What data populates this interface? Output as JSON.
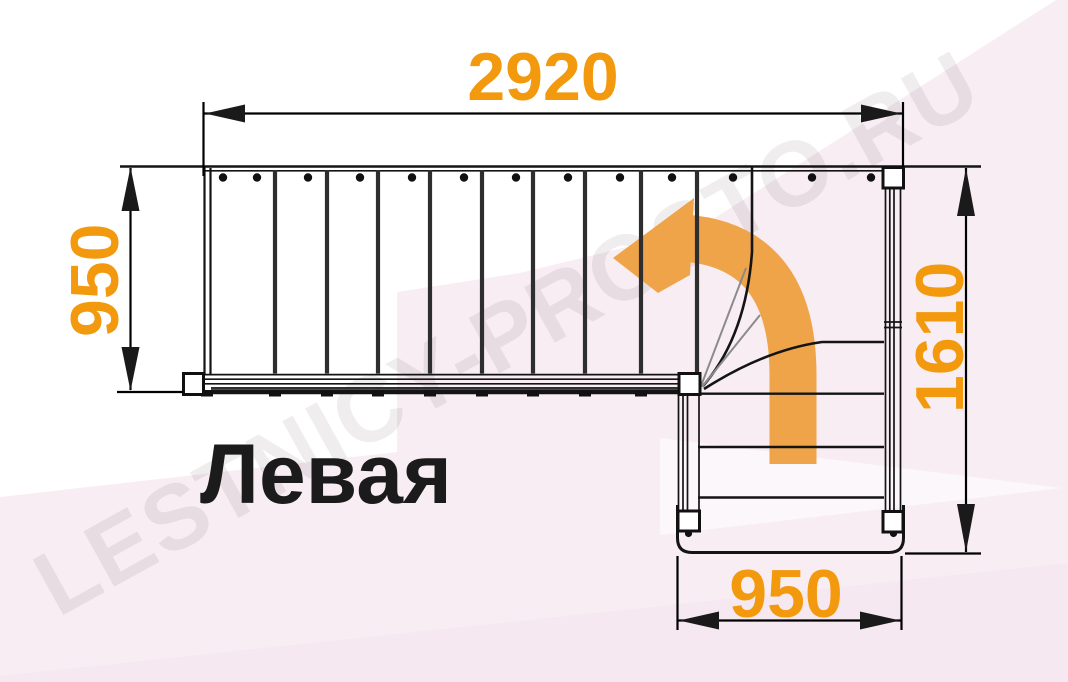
{
  "diagram": {
    "type": "staircase-floor-plan-top-view",
    "caption": "Левая",
    "watermark": "LESTNICY-PROSTO.RU",
    "direction_arrow_icon": "curved-arrow-up-then-left",
    "dimensions": {
      "top": "2920",
      "left": "950",
      "right": "1610",
      "bottom": "950"
    },
    "colors": {
      "dimension_text": "#f2990d",
      "arrow_fill": "#efa449",
      "background_tint": "#f8edf3",
      "line": "#141414"
    }
  }
}
